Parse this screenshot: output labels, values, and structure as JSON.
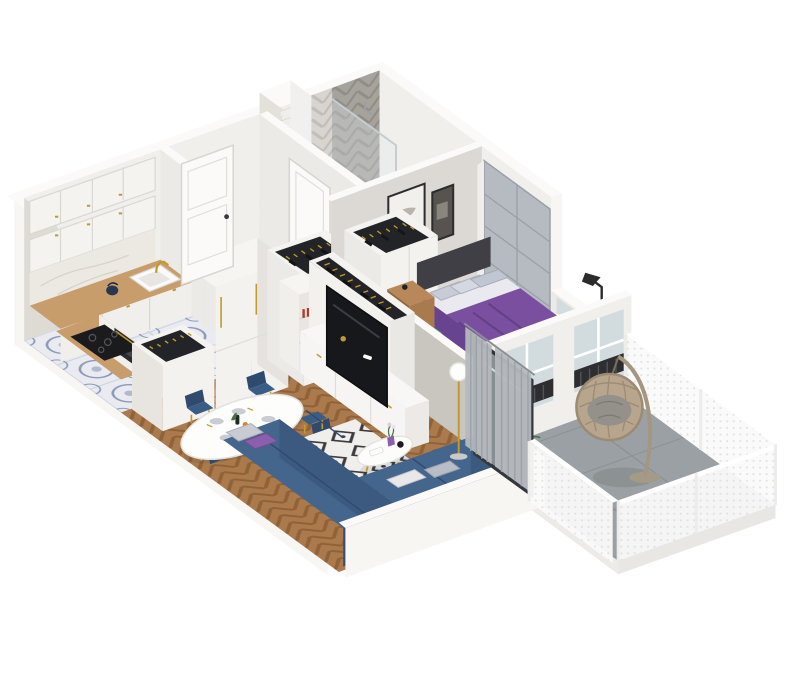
{
  "canvas": {
    "width": 793,
    "height": 700,
    "background": "#ffffff"
  },
  "scene": {
    "type": "isometric-3d-apartment-floor-plan",
    "rooms": [
      {
        "name": "kitchen",
        "items": [
          "upper-cabinets",
          "wood-counter",
          "sink",
          "gold-faucet",
          "kettle",
          "cooktop",
          "built-in-oven",
          "marble-backsplash",
          "fridge-tall-units",
          "open-bottle-drawer-unit",
          "patterned-tile-floor"
        ]
      },
      {
        "name": "entry-hall",
        "items": [
          "front-door",
          "open-closet-with-hanging-clothes",
          "gray-tile-floor"
        ]
      },
      {
        "name": "bathroom",
        "items": [
          "herringbone-tile-wall",
          "subway-tile-chimney",
          "wall-hung-toilet",
          "walk-in-shower",
          "bathroom-door"
        ]
      },
      {
        "name": "bedroom",
        "items": [
          "double-bed-purple-bedding",
          "gray-pillows",
          "wall-art-frames",
          "wood-nightstand",
          "alarm-clock",
          "black-floor-lamp",
          "gray-paneled-wardrobe",
          "open-wardrobe-with-clothes",
          "dresser-with-green-box",
          "white-desk",
          "desk-lamp",
          "purple-office-chair",
          "gray-rug",
          "windows-with-radiators",
          "leaning-tv"
        ]
      },
      {
        "name": "living-dining-room",
        "items": [
          "oval-dining-table",
          "place-settings",
          "blue-velvet-chairs",
          "blue-corner-sofa",
          "throw-pillows",
          "diamond-pattern-rug",
          "round-coffee-table",
          "purple-vase-flowers",
          "tv-sideboard",
          "flat-tv",
          "open-wardrobe-with-clothes",
          "zigzag-bookshelf",
          "globe-floor-lamp",
          "gray-curtains",
          "sliding-glass-balcony-door",
          "herringbone-wood-floor"
        ]
      },
      {
        "name": "balcony",
        "items": [
          "hanging-egg-chair",
          "potted-plant",
          "perforated-white-railing",
          "large-gray-tile-floor"
        ]
      }
    ]
  },
  "palette": {
    "wallFace": "#f1efec",
    "wallShade": "#dedbd5",
    "wallRim": "#fbfaf8",
    "wallOuter": "#f7f6f3",
    "wallDark": "#d3d0ca",
    "woodCounter": "#c79e6b",
    "woodCounterDark": "#b68a55",
    "cabinetWhite": "#f4f3f0",
    "cabinetLine": "#dbd8d3",
    "herringboneBase": "#aa7a4c",
    "herringboneLine": "#8f6238",
    "bedroomWoodBase": "#b28257",
    "bedroomWoodLine": "#9d7048",
    "kitchenTileBase": "#e9ebf1",
    "kitchenTileInk": "#8b9ab8",
    "hallTileBase": "#cdd0d3",
    "hallTileLine": "#b9bcbf",
    "bathTileBase": "#c7cacc",
    "balconyTileBase": "#9aa0a3",
    "balconyTileLine": "#868c8f",
    "bathWallTileBase": "#d8d5d0",
    "bathWallTileLine": "#c1bdb7",
    "showerWallBase": "#a6a29c",
    "showerWallLine": "#918d87",
    "subwayBase": "#f0eeea",
    "sofaBlue": "#44658c",
    "sofaBlueDark": "#374f74",
    "sofaBlueSide": "#3c5a80",
    "chairBlue": "#3a5d85",
    "chairBlueDark": "#2f4a6c",
    "bedPurple": "#7b4fa0",
    "bedPurpleDark": "#643f85",
    "sheetWhite": "#e9e9ef",
    "pillowGray": "#c7ccd6",
    "accentPurple": "#8a5fae",
    "officeChairPurple": "#7d3f9b",
    "rugBase": "#f0efeb",
    "rugInk": "#3b3b40",
    "bedroomRug": "#ccd2d4",
    "tvBlack": "#17181c",
    "gold": "#c2992c",
    "wardrobeGray": "#b6bbc1",
    "wardrobeGrayLine": "#9aa0a7",
    "curtain": "#b5b9be",
    "glass": "#cdd8dd",
    "doorFrameDark": "#33363a",
    "radiatorDark": "#2e2e31",
    "railWhite": "#fafafa",
    "plantGreen": "#477046",
    "plantGreenLight": "#5f8a55",
    "rattan": "#b7a68d",
    "rattanDark": "#9c8b72",
    "cushionGray": "#94908a",
    "greenBox": "#52ad3f",
    "darkInterior": "#232427",
    "marble": "#ece9e3",
    "toiletWhite": "#fafaf8"
  }
}
